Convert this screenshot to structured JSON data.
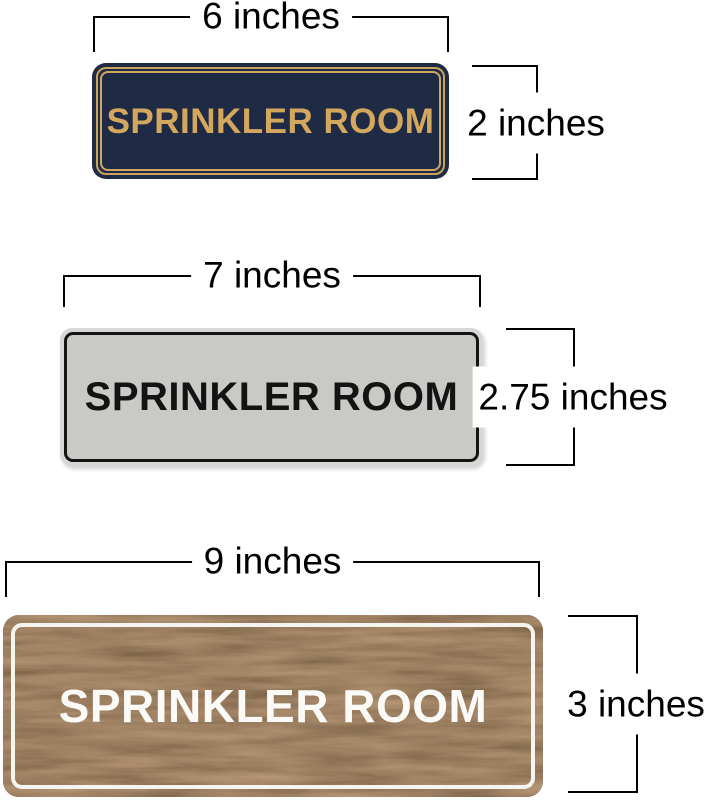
{
  "page": {
    "background": "#ffffff",
    "dimension_line_color": "#000000",
    "dimension_text_color": "#000000"
  },
  "signs": [
    {
      "name": "navy-gold",
      "label": "SPRINKLER ROOM",
      "width_label": "6 inches",
      "height_label": "2 inches",
      "colors": {
        "background": "#1f2a44",
        "border": "#c8a35e",
        "text": "#d4a75f"
      }
    },
    {
      "name": "silver-black",
      "label": "SPRINKLER ROOM",
      "width_label": "7 inches",
      "height_label": "2.75 inches",
      "colors": {
        "background": "#c9c9c6",
        "rim": "#d7d7d5",
        "border": "#141414",
        "text": "#131313"
      }
    },
    {
      "name": "walnut-white",
      "label": "SPRINKLER ROOM",
      "width_label": "9 inches",
      "height_label": "3 inches",
      "colors": {
        "background": "#4e3826",
        "border": "#f6f4ee",
        "text": "#fbfaf6"
      }
    }
  ]
}
